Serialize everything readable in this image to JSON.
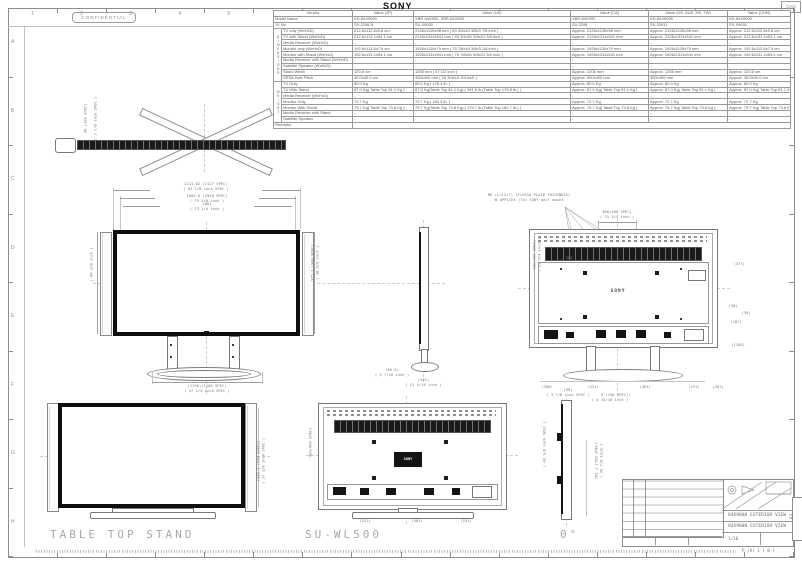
{
  "page": {
    "confidential": "CONFIDENTIAL",
    "brand": "SONY",
    "corner_tag": "CAD",
    "page_note": "P.(A) 1 ( 8 )"
  },
  "ruler": {
    "top_numbers": [
      "1",
      "2",
      "3",
      "4",
      "5",
      "6",
      "7",
      "8",
      "9",
      "10",
      "11",
      "12",
      "13",
      "14",
      "15",
      "16"
    ],
    "side_letters": [
      "A",
      "B",
      "C",
      "D",
      "E",
      "F",
      "G",
      "H"
    ]
  },
  "captions": {
    "table_top_stand": "TABLE TOP STAND",
    "su_wl500": "SU-WL500",
    "zero_deg": "0°"
  },
  "spec_table": {
    "group_labels": {
      "dimensions": "DIMENSIONS",
      "weight": "WEIGHT"
    },
    "header": {
      "vendor": "Vendor",
      "cols": [
        "Value (JP)",
        "Value (US)",
        "Value (CA)",
        "Value (UK, AUS, HK, TW)",
        "Value (CHN)"
      ]
    },
    "info_rows": [
      {
        "label": "Model Name",
        "values": [
          "KD-84X9000",
          "XBR-84X900, XBR-84X905",
          "XBR-84X900",
          "KD-84X9005",
          "KD-84X9000"
        ]
      },
      {
        "label": "JV No",
        "values": [
          "SV-2298 N",
          "SV-X9000",
          "SV-2298",
          "SV-33911",
          "SV-X9001"
        ]
      }
    ],
    "dim_rows": [
      {
        "label": "TV only (WxHxD)",
        "values": [
          "212.6x112.6x9.8 cm",
          "2126x1126x98 mm ( 83 3/4x44 3/8x3 7/8 inch )",
          "Approx. 2126x1126x98 mm",
          "Approx. 2126x1126x98 mm",
          "Approx. 212.6x112.6x9.8 cm"
        ]
      },
      {
        "label": "TV with Stand (WxHxD)",
        "values": [
          "212.6x131.1x54.1 cm",
          "2126x1311x541 mm ( 83 3/4x51 5/8x21 3/8 inch )",
          "Approx. 2126x1311x541 mm",
          "Approx. 2126x1311x541 mm",
          "Approx. 212.6x131.1x54.1 cm"
        ]
      },
      {
        "label": "Media Receiver (WxHxD)",
        "values": [
          "-",
          "-",
          "-",
          "-",
          "-"
        ]
      },
      {
        "label": "Monitor only (WxHxD)",
        "values": [
          "192.6x112.6x7.9 cm",
          "1926x1126x79 mm ( 75 7/8x44 3/8x3 1/8 inch )",
          "Approx. 1926x1126x79 mm",
          "Approx. 1926x1126x79 mm",
          "Approx. 192.6x112.6x7.9 cm"
        ]
      },
      {
        "label": "Monitor with Stand (WxHxD)",
        "values": [
          "192.6x131.1x54.1 cm",
          "1926x1311x541 mm ( 75 7/8x51 5/8x21 3/8 inch )",
          "Approx. 1926x1311x541 mm",
          "Approx. 1926x1311x541 mm",
          "Approx. 192.6x131.1x54.1 cm"
        ]
      },
      {
        "label": "Media Receiver with Stand (WxHxD)",
        "values": [
          "-",
          "-",
          "-",
          "-",
          "-"
        ]
      },
      {
        "label": "Satellite Speaker (WxHxD)",
        "values": [
          "-",
          "-",
          "-",
          "-",
          "-"
        ]
      },
      {
        "label": "Stand Width",
        "values": [
          "120.6 cm",
          "1206 mm ( 47 1/2 inch )",
          "Approx. 1206 mm",
          "Approx. 1206 mm",
          "Approx. 120.6 cm"
        ]
      },
      {
        "label": "VESA Hole Pitch",
        "values": [
          "40.0x40.0 cm",
          "400x400 mm ( 15 3/4x15 3/4 inch )",
          "Approx. 400x400 mm",
          "400x400 mm",
          "Approx. 40.0x40.0 cm"
        ]
      }
    ],
    "weight_rows": [
      {
        "label": "TV Only",
        "values": [
          "80.0 Kg",
          "80.0 Kg ( 176.4 lb. )",
          "Approx. 80.0 Kg",
          "Approx. 80.0 Kg",
          "Approx. 80.0 Kg"
        ]
      },
      {
        "label": "TV With Stand",
        "values": [
          "87.0 Kg( Table Top 81.1 Kg )",
          "87.0 Kg(Table Top 81.1 Kg) ( 191.8 lb.(Table Top 178.8 lb.) )",
          "Approx. 87.0 Kg( Table Top 81.1 Kg )",
          "Approx. 87.0 Kg( Table Top 81.1 Kg )",
          "Approx. 87.0 Kg( Table Top 81.1 Kg )"
        ]
      },
      {
        "label": "Media Receiver (WxHxD)",
        "values": [
          "-",
          "-",
          "-",
          "-",
          "-"
        ]
      },
      {
        "label": "Monitor Only",
        "values": [
          "72.7 Kg",
          "72.7 Kg ( 160.3 lb. )",
          "Approx. 72.7 Kg",
          "Approx. 72.7 Kg",
          "Approx. 72.7 Kg"
        ]
      },
      {
        "label": "Monitor With Stand",
        "values": [
          "79.7 Kg( Table Top 73.8 Kg )",
          "79.7 Kg(Table Top 73.8 Kg) ( 175.7 lb.(Table Top 162.7 lb.) )",
          "Approx. 79.7 Kg( Table Top 73.8 Kg )",
          "Approx. 79.7 Kg( Table Top 73.8 Kg )",
          "Approx. 79.7 Kg( Table Top 73.8 Kg )"
        ]
      },
      {
        "label": "Media Receiver with Stand",
        "values": [
          "-",
          "-",
          "-",
          "-",
          "-"
        ]
      },
      {
        "label": "Satellite Speaker",
        "values": [
          "-",
          "-",
          "-",
          "-",
          "-"
        ]
      }
    ],
    "remarks_label": "Remarks"
  },
  "views": {
    "top": {
      "dim_a": "98 (100 SPEC)",
      "dim_b": "( 3 7/8 inch SPEC )"
    },
    "front": {
      "dim_w1": "2111.82 (2127 SPEC)\n( 83 1/8 inch SPEC )",
      "dim_w2": "1905.6 (1920 SPEC)\n( 75 5/8 inch )",
      "dim_w3": "1861\n( 73 1/4 inch )",
      "dim_h_left": "( 44 3/8 inch )",
      "dim_h_right": "975.1 (980 SPEC)\n( 38 5/8 inch )",
      "dim_base": "(1196)(1200 SPEC)\n( 47 1/4 inch SPEC )"
    },
    "side": {
      "dim_d": "(541)\n( 21 5/16 inch )",
      "dim_d2": "(86.5)\n( 3 7/16 inch )"
    },
    "rear": {
      "note_line1": "M6 (L=12+T) (T=VESA PLATE THICKNESS)",
      "note_line2": "※ APPLIES (To) SONY wall mount",
      "dim_vesa_h": "400(400 SPEC)\n( 15 3/4 inch )",
      "dim_vesa_v": "400(400 SPEC)\n( 15 3/4 inch )",
      "dim_300": "300",
      "logo": "SONY",
      "dim_r1": "(377)",
      "dim_r2": "(58)",
      "dim_r3": "(30)",
      "dim_r4": "(187)",
      "dim_r5": "(1185)",
      "dim_b1": "(398)",
      "dim_b2": "(321)",
      "dim_b3": "(463)",
      "dim_b4": "(191)",
      "dim_b5": "(207)",
      "dim_center": "(124.5 (130 SPEC))\n( 4 15/16 inch )"
    },
    "front2": {
      "dim_h": "(938.1 (939 SPEC))\n( 37 3/8 inch SPEC )"
    },
    "rear2": {
      "logo": "SONY",
      "dim_left": "400(400 SPEC)",
      "dim_b1": "(321)",
      "dim_b2": "(463)",
      "dim_b3": "(191)"
    },
    "side2": {
      "dim_top": "(98)\n( 3 7/8 inch SPEC )",
      "dim_left": "( 42 1/8 inch SPEC )",
      "dim_right": "781.1 (785 SPEC)\n( 30 7/8 inch )"
    }
  },
  "title_block": {
    "title_line1": "84X9000 EXTERIOR VIEW",
    "title_line2": "84X9000 EXTERIOR VIEW",
    "scale": "1/10",
    "sheet_size": "A3"
  }
}
